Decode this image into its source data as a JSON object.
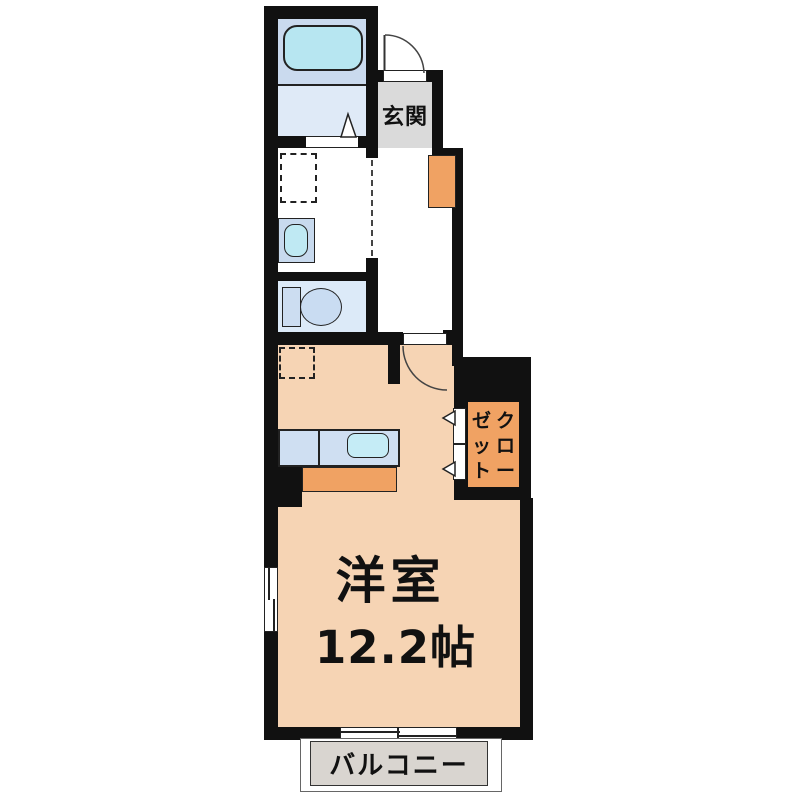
{
  "floorplan": {
    "rooms": {
      "entrance": {
        "name": "玄関"
      },
      "main_room": {
        "name": "洋室",
        "size": "12.2帖"
      },
      "closet": {
        "name": "クローゼット",
        "col_right": "クロー",
        "col_left": "ゼット"
      },
      "balcony": {
        "name": "バルコニー"
      }
    },
    "fixtures": [
      "bathtub",
      "bathroom",
      "washing-machine-space",
      "vanity-sink",
      "toilet",
      "refrigerator-space",
      "kitchen-counter",
      "kitchen-sink",
      "lower-counter",
      "shoe-cabinet",
      "entrance-door",
      "room-door",
      "sliding-door",
      "closet-folding-door",
      "window-left",
      "window-balcony"
    ],
    "colors": {
      "wall": "#111111",
      "room_floor": "#f6d4b4",
      "bath_panel": "#cadaee",
      "bath_floor": "#dfeaf7",
      "tub": "#b7e6f1",
      "toilet_floor": "#dceaf8",
      "vanity": "#c8daee",
      "basin": "#bfe9f3",
      "kitchen_counter": "#cfdff2",
      "kitchen_sink": "#c5ecf6",
      "accent_orange": "#f0a263",
      "genkan_gray": "#dadada",
      "balcony_gray": "#d9d5d0"
    }
  }
}
